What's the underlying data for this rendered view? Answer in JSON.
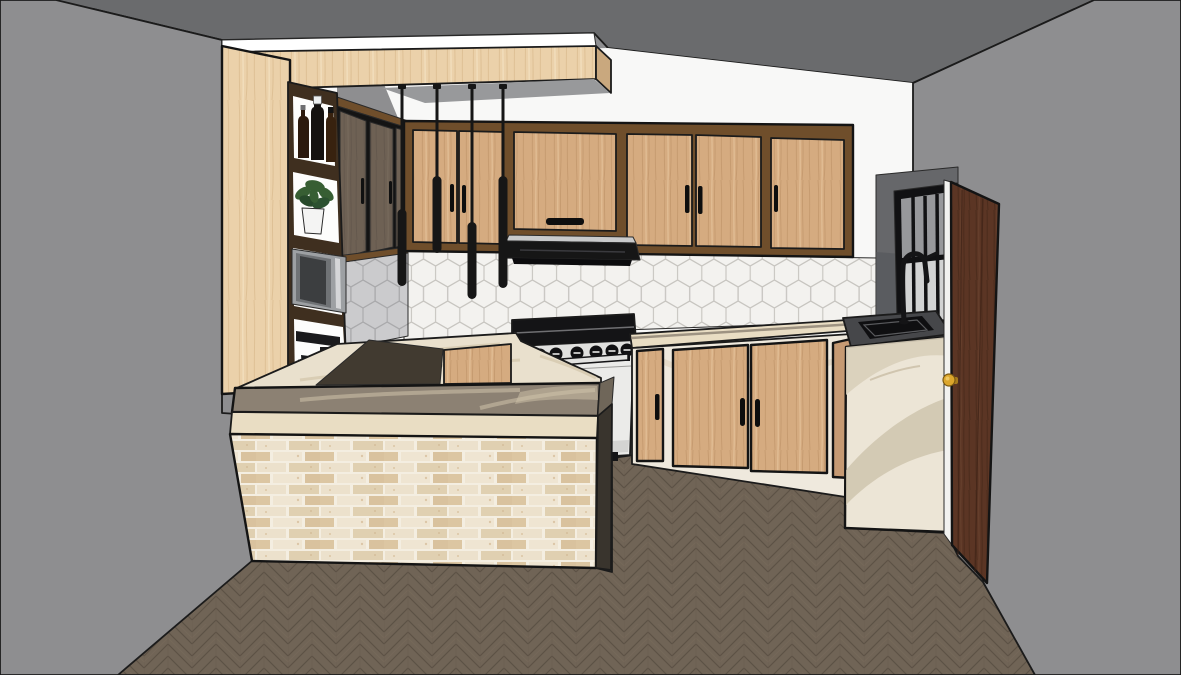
{
  "scene": {
    "description": "3D line-style interior render of a modern kitchen with peninsula bar, wood cabinetry, hexagon tile backsplash, pendant lights, gas range, black sink and an open wooden entry door",
    "room": "kitchen",
    "render_style": "sketchup-like edge render"
  },
  "objects": {
    "pendant_lights": {
      "count": 4,
      "finish": "matte black"
    },
    "stove": {
      "type": "freestanding range",
      "knob_count": 7
    },
    "upper_cabinets": {
      "back_wall_doors": 6,
      "left_wall_doors": 3
    },
    "base_cabinets_right": {
      "doors": 4
    },
    "shelf_column_items": [
      "bottles",
      "plant",
      "microwave",
      "coffee-maker"
    ],
    "bar_peninsula": {
      "front_finish": "whitewashed brick",
      "top_finish": "stone"
    },
    "floor": {
      "pattern": "herringbone"
    },
    "backsplash": {
      "pattern": "hexagon tile"
    },
    "window": {
      "sashes": 2,
      "vertical_bars": 3,
      "frame": "black"
    },
    "entry_door": {
      "state": "open",
      "knob": "brass"
    }
  },
  "colors": {
    "ceiling": "#6a6b6d",
    "wall": "#8e8e90",
    "wall_shadow": "#98999b",
    "back_wall": "#f8f8f7",
    "white": "#ffffff",
    "floor": "#706456",
    "floor_line": "#5c5145",
    "hex_fill": "#f3f2ef",
    "hex_line": "#c7c5c0",
    "hex_side_fill": "#cbcbcd",
    "hex_side_line": "#a9a9ab",
    "walnut": "#6f4e2b",
    "oak_base": "#d5ab80",
    "oak_pale": "#ebd1aa",
    "door_dark": "#6e6154",
    "ink": "#161616",
    "stove_body": "#ebebe9",
    "stove_shade": "#d4d4d2",
    "knob_panel": "#e0e0de",
    "metal": "#c9cacb",
    "counter": "#8c8173",
    "counter_vein": "#cfc3a9",
    "counter_cream": "#e9e0cd",
    "counter_cream_vein": "#d4c8ae",
    "travertine": "#e9ddc3",
    "brick_bg": "#f4eee1",
    "interior_shadow": "#413a30",
    "base_cream": "#efe9dd",
    "marble": "#ece5d6",
    "marble_vein1": "#d9cfba",
    "marble_vein2": "#cbc0a8",
    "sink_counter": "#46474a",
    "basin": "#0f0f11",
    "window_top": "#97989b",
    "window_bottom": "#d2d3d3",
    "return_wall": "#66676a",
    "entry_door": "#5b3524",
    "jamb": "#f2f2f0",
    "knob": "#dca62c",
    "plant": "#375e33",
    "plant_dark": "#27492a",
    "pot": "#f4f4f3",
    "microwave": "#9da0a3",
    "microwave_door": "#3c3e40",
    "coffee": "#1a1a1c",
    "bottle1": "#2c1a0e",
    "bottle2": "#151210",
    "bottle3": "#38220f"
  }
}
